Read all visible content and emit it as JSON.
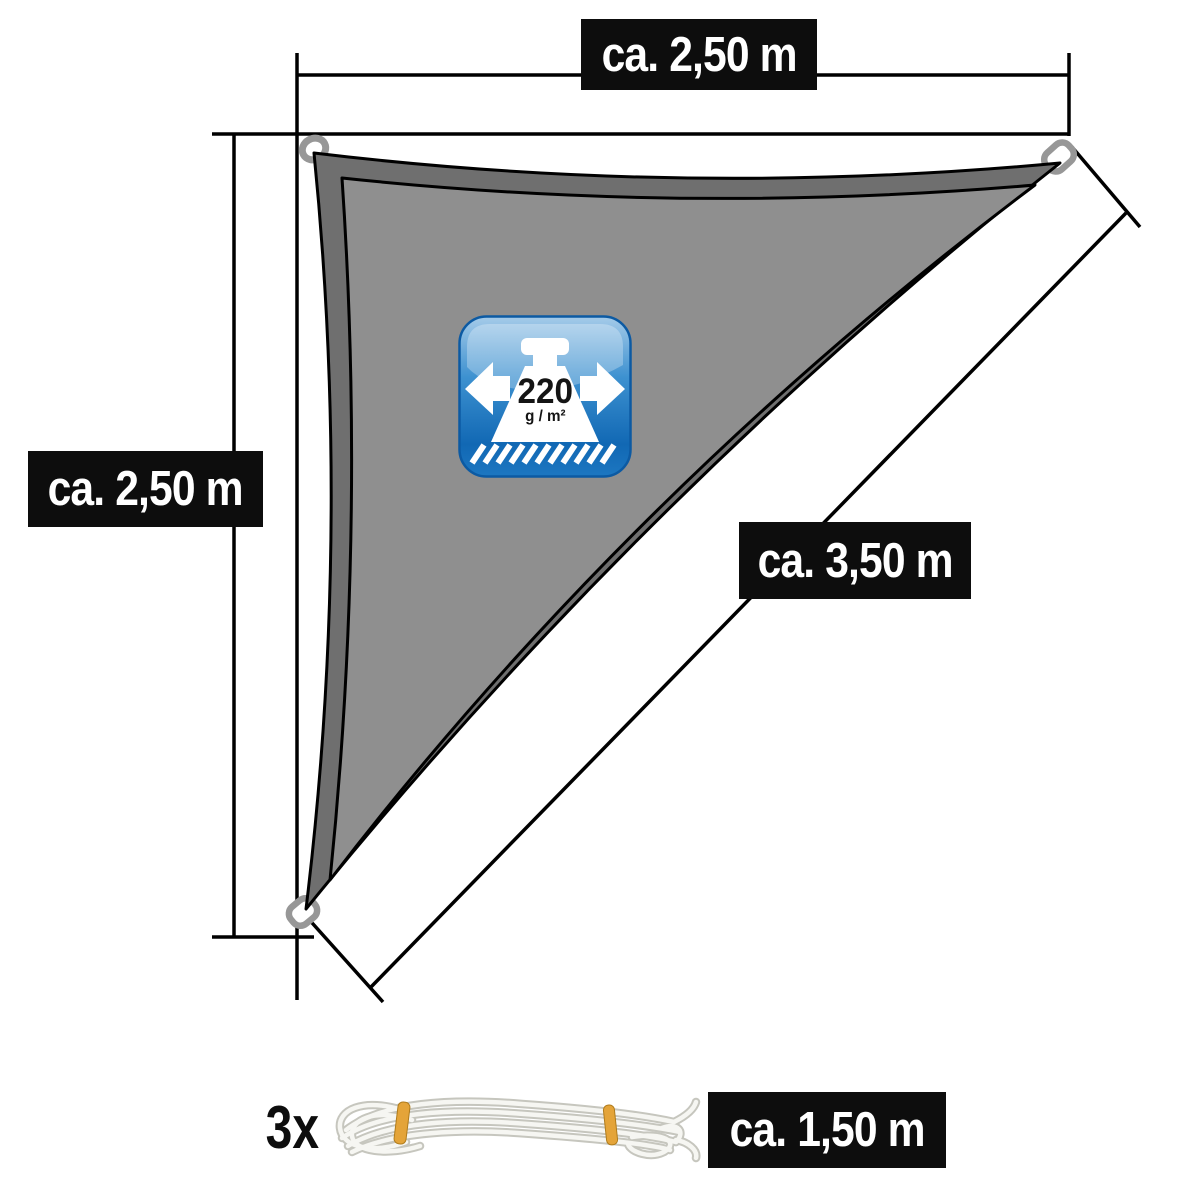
{
  "labels": {
    "top_width": "ca. 2,50 m",
    "left_height": "ca. 2,50 m",
    "diagonal_length": "ca. 3,50 m",
    "rope_length": "ca. 1,50 m",
    "rope_quantity": "3x"
  },
  "badge": {
    "weight_value": "220",
    "weight_unit": "g / m²"
  },
  "colors": {
    "label_background": "#0d0d0d",
    "label_text": "#ffffff",
    "line_black": "#000000",
    "sail_fill": "#8f8f8f",
    "sail_border": "#6f6f6f",
    "ring_gray": "#979797",
    "badge_blue_top": "#a5cbe9",
    "badge_blue_mid": "#3d91d0",
    "badge_blue_bottom": "#1168b4",
    "rope_band_yellow": "#e4a439",
    "rope_white": "#f6f6f2"
  },
  "icons": {
    "badge_weight": "weight-icon",
    "badge_arrow_left": "arrow-left-icon",
    "badge_arrow_right": "arrow-right-icon",
    "corner_ring": "corner-ring-icon",
    "rope": "rope-image"
  }
}
